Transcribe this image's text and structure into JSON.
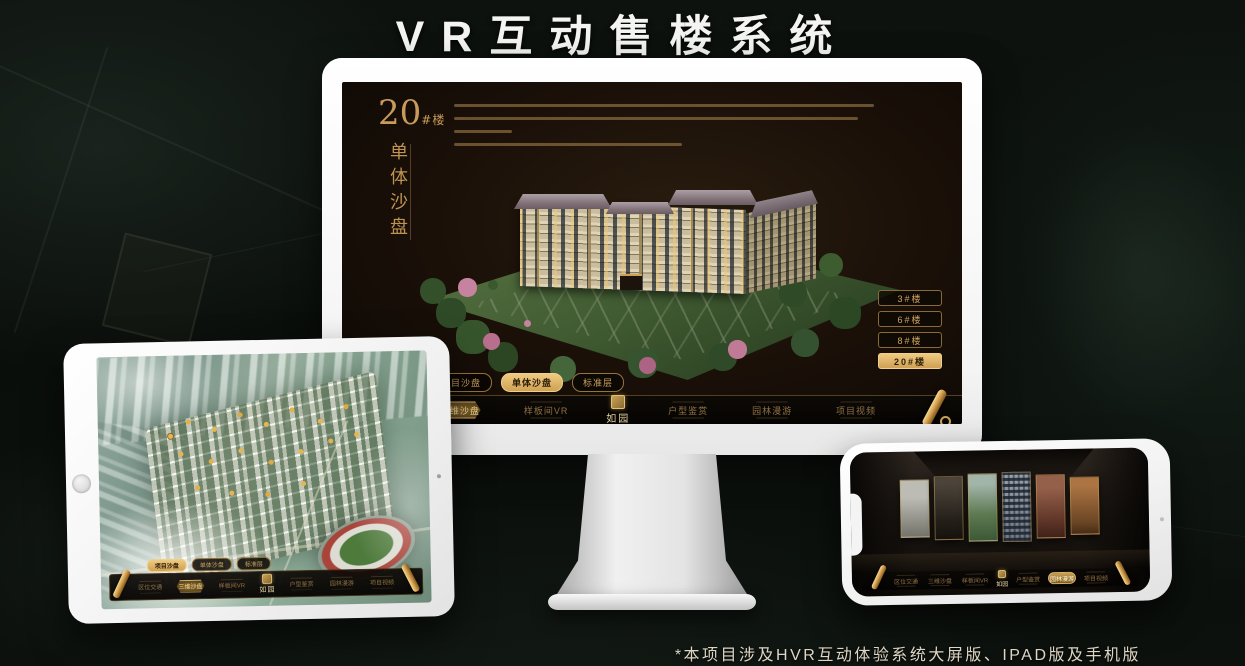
{
  "page": {
    "title": "VR互动售楼系统",
    "footnote": "*本项目涉及HVR互动体验系统大屏版、IPAD版及手机版"
  },
  "brand": {
    "name": "如园"
  },
  "colors": {
    "gold": "#c89b5a",
    "gold_bright": "#eeca80",
    "screen_background": "#1a1008",
    "page_background": "#0b100c",
    "title_text": "#f4f4f2"
  },
  "monitor": {
    "heading": {
      "number": "20",
      "suffix": "#楼",
      "subtitle": "单体沙盘"
    },
    "floor_buttons": [
      {
        "label": "3#楼",
        "active": false
      },
      {
        "label": "6#楼",
        "active": false
      },
      {
        "label": "8#楼",
        "active": false
      },
      {
        "label": "20#楼",
        "active": true
      }
    ],
    "tabs": [
      {
        "label": "项目沙盘",
        "active": false
      },
      {
        "label": "单体沙盘",
        "active": true
      },
      {
        "label": "标准层",
        "active": false
      }
    ],
    "nav": {
      "items": [
        {
          "label": "区位交通",
          "active": false
        },
        {
          "label": "三维沙盘",
          "active": true
        },
        {
          "label": "样板间VR",
          "active": false
        },
        {
          "label": "户型鉴赏",
          "active": false
        },
        {
          "label": "园林漫游",
          "active": false
        },
        {
          "label": "项目视频",
          "active": false
        }
      ]
    }
  },
  "tablet": {
    "tabs": [
      {
        "label": "项目沙盘",
        "active": true
      },
      {
        "label": "单体沙盘",
        "active": false
      },
      {
        "label": "标准层",
        "active": false
      }
    ],
    "nav": {
      "items": [
        {
          "label": "区位交通",
          "active": false
        },
        {
          "label": "三维沙盘",
          "active": true
        },
        {
          "label": "样板间VR",
          "active": false
        },
        {
          "label": "户型鉴赏",
          "active": false
        },
        {
          "label": "园林漫游",
          "active": false
        },
        {
          "label": "项目视频",
          "active": false
        }
      ]
    }
  },
  "phone": {
    "nav": {
      "items": [
        {
          "label": "区位交通",
          "active": false
        },
        {
          "label": "三维沙盘",
          "active": false
        },
        {
          "label": "样板间VR",
          "active": false
        },
        {
          "label": "户型鉴赏",
          "active": false
        },
        {
          "label": "园林漫游",
          "active": true
        },
        {
          "label": "项目视频",
          "active": false
        }
      ]
    }
  }
}
